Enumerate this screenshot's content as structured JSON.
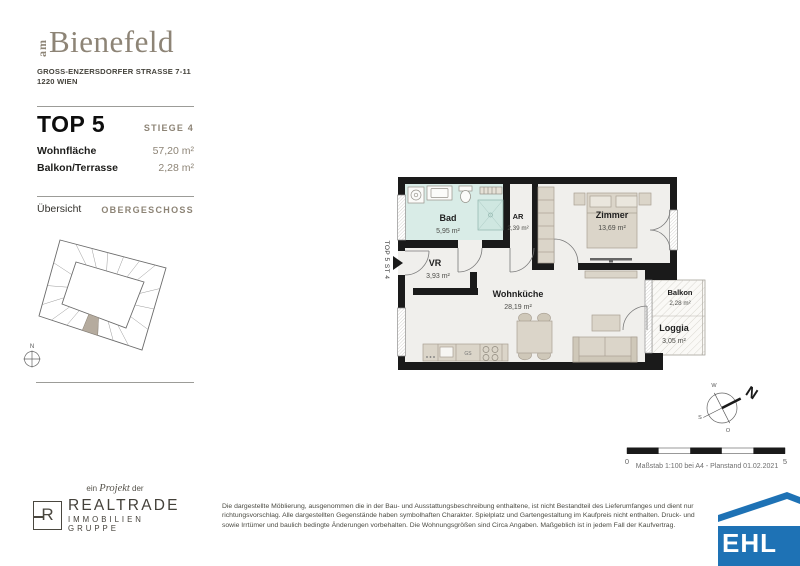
{
  "header": {
    "logo_prefix": "am",
    "logo_name": "Bienefeld",
    "address_line1": "GROSS-ENZERSDORFER STRASSE 7-11",
    "address_line2": "1220 WIEN"
  },
  "unit": {
    "title": "TOP 5",
    "stiege": "STIEGE 4",
    "rows": [
      {
        "label": "Wohnfläche",
        "value": "57,20 m²"
      },
      {
        "label": "Balkon/Terrasse",
        "value": "2,28 m²"
      }
    ]
  },
  "overview": {
    "label": "Übersicht",
    "floor": "OBERGESCHOSS",
    "compass_letter": "N"
  },
  "plan": {
    "entrance_label": "TOP 5 ST 4",
    "kitchen_gs": "GS",
    "rooms": [
      {
        "name": "Bad",
        "area": "5,95 m²"
      },
      {
        "name": "AR",
        "area": "2,39 m²"
      },
      {
        "name": "Zimmer",
        "area": "13,69 m²"
      },
      {
        "name": "VR",
        "area": "3,93 m²"
      },
      {
        "name": "Wohnküche",
        "area": "28,19 m²"
      },
      {
        "name": "Balkon",
        "area": "2,28 m²"
      },
      {
        "name": "Loggia",
        "area": "3,05 m²"
      }
    ]
  },
  "compass": {
    "n": "N",
    "w": "W",
    "s": "S",
    "o": "O"
  },
  "scalebar": {
    "start": "0",
    "end": "5",
    "caption": "Maßstab 1:100 bei A4 - Planstand 01.02.2021"
  },
  "project": {
    "pre": "ein ",
    "word": "Projekt",
    "post": " der",
    "logo_letter": "R",
    "name": "REALTRADE",
    "subtitle": "IMMOBILIEN GRUPPE"
  },
  "disclaimer": {
    "line1": "Die dargestellte Möblierung, ausgenommen die in der Bau- und Ausstattungsbeschreibung enthaltene, ist nicht Bestandteil des Lieferumfanges und dient nur",
    "line2": "richtungsvorschlag. Alle dargestellten Gegenstände haben symbolhaften Charakter. Spielplatz und Gartengestaltung im Kaufpreis nicht enthalten. Druck- und",
    "line3": "sowie Irrtümer und baulich bedingte Änderungen vorbehalten. Die Wohnungsgrößen sind Circa Angaben. Maßgeblich ist in jedem Fall der Kaufvertrag."
  },
  "ehl": {
    "text": "EHL"
  },
  "colors": {
    "accent_taupe": "#8d8476",
    "wall_black": "#1a1a1a",
    "bad_fill": "#d9ece7",
    "furniture": "#dbd5c9",
    "highlight_unit": "#b5ab9e",
    "ehl_blue": "#1e72b5"
  }
}
